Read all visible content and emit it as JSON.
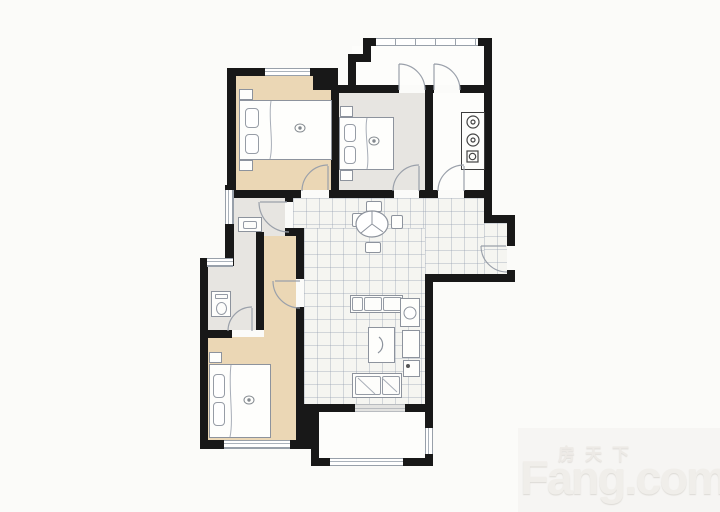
{
  "meta": {
    "type": "residential-floor-plan",
    "width_px": 720,
    "height_px": 512
  },
  "watermark": {
    "cn": "房天下",
    "en": "Fang.com"
  },
  "palette": {
    "background": "#fbfbf9",
    "wall": "#181818",
    "bedroom_floor": "#ebd7b5",
    "bathroom_floor": "#e7e5e1",
    "tile_floor": "#f5f5f1",
    "white_floor": "#fdfdfb",
    "furniture_stroke": "#8d939d",
    "watermark_text": "#f0eeea"
  },
  "floor_plan": {
    "door_count": 9,
    "window_count": 7,
    "rooms": [
      {
        "id": "bedroom-top-left",
        "floor": "beige",
        "furniture": [
          "double-bed",
          "pillows",
          "nightstands",
          "window-top"
        ]
      },
      {
        "id": "bedroom-top-middle",
        "floor": "gray",
        "furniture": [
          "double-bed",
          "pillows",
          "nightstands"
        ]
      },
      {
        "id": "kitchen",
        "floor": "white",
        "furniture": [
          "stove-counter-with-burners"
        ]
      },
      {
        "id": "balcony-top",
        "floor": "white",
        "furniture": [
          "window-band",
          "two-doors"
        ]
      },
      {
        "id": "dining-hall",
        "floor": "tile",
        "furniture": [
          "round-dining-table",
          "four-chairs"
        ]
      },
      {
        "id": "bathroom-upper",
        "floor": "gray",
        "furniture": [
          "wash-cabinet",
          "window-left"
        ]
      },
      {
        "id": "bathroom-lower",
        "floor": "gray",
        "furniture": [
          "toilet",
          "window-top"
        ]
      },
      {
        "id": "bedroom-bottom-left",
        "floor": "beige",
        "furniture": [
          "double-bed",
          "pillows",
          "nightstand",
          "window-bottom"
        ]
      },
      {
        "id": "living-room",
        "floor": "tile",
        "furniture": [
          "sofa-set",
          "corner-seat",
          "coffee-table",
          "side-tables",
          "tv-cabinet"
        ]
      },
      {
        "id": "entry-vestibule",
        "floor": "tile",
        "furniture": [
          "entry-door"
        ]
      },
      {
        "id": "balcony-bottom",
        "floor": "white",
        "furniture": [
          "window-band",
          "sliding-door"
        ]
      }
    ]
  }
}
